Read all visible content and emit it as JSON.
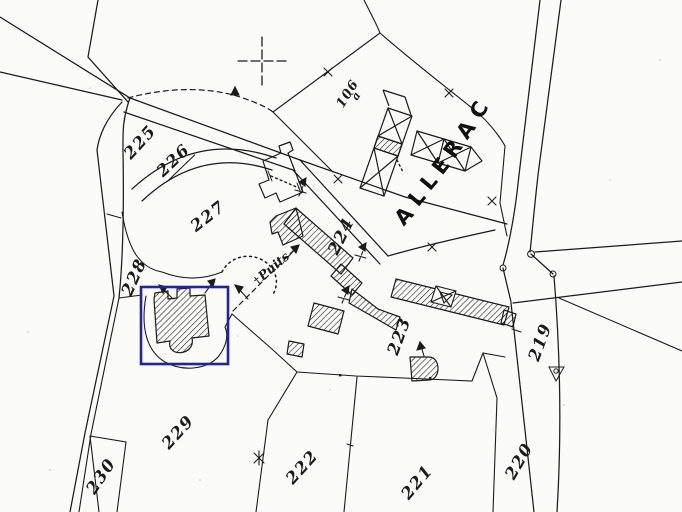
{
  "map": {
    "title": "cadastral-extract",
    "background": "#fbfbf8",
    "ink": "#1b1b1b",
    "place": {
      "name": "ALLERAC",
      "letters": [
        "A",
        "L",
        "L",
        "E",
        "R",
        "A",
        "C"
      ]
    },
    "well": {
      "icon": "†",
      "label": "Puits"
    },
    "area": {
      "number": "106",
      "letter": "à"
    },
    "parcels": [
      {
        "label": "225",
        "x": 140,
        "y": 142,
        "rot": -48
      },
      {
        "label": "226",
        "x": 174,
        "y": 161,
        "rot": -44,
        "underline": true
      },
      {
        "label": "227",
        "x": 208,
        "y": 216,
        "rot": -38
      },
      {
        "label": "228",
        "x": 134,
        "y": 277,
        "rot": -66
      },
      {
        "label": "229",
        "x": 178,
        "y": 432,
        "rot": -48
      },
      {
        "label": "230",
        "x": 101,
        "y": 476,
        "rot": -56
      },
      {
        "label": "222",
        "x": 302,
        "y": 467,
        "rot": -48
      },
      {
        "label": "221",
        "x": 417,
        "y": 482,
        "rot": -50
      },
      {
        "label": "220",
        "x": 519,
        "y": 461,
        "rot": -60
      },
      {
        "label": "219",
        "x": 540,
        "y": 342,
        "rot": -70
      },
      {
        "label": "223",
        "x": 399,
        "y": 336,
        "rot": -70
      },
      {
        "label": "224",
        "x": 341,
        "y": 236,
        "rot": -64
      }
    ],
    "highlight": {
      "x": 141,
      "y": 287,
      "width": 87,
      "height": 77,
      "color": "#1e23ab",
      "stroke_width": 2.6
    }
  }
}
